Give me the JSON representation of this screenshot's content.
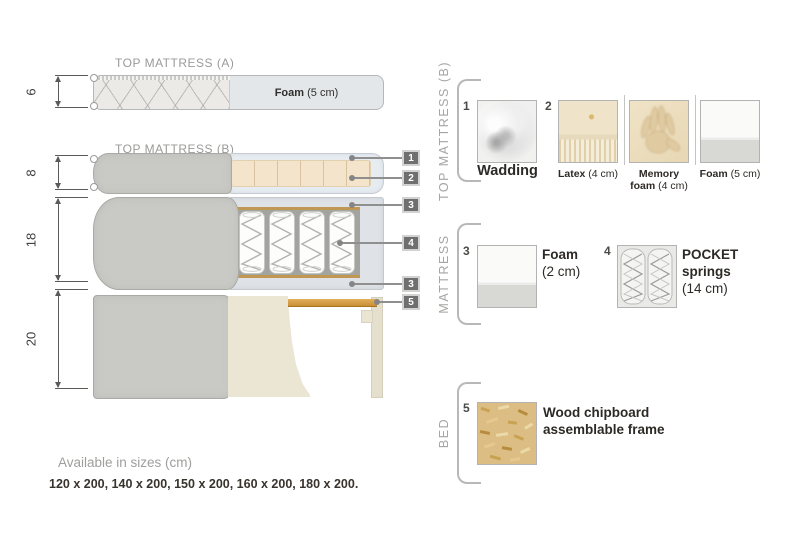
{
  "diagram": {
    "sections": {
      "top_a": {
        "title": "TOP MATTRESS (A)",
        "height_cm": "6",
        "foam_bold": "Foam",
        "foam_rest": " (5 cm)"
      },
      "top_b": {
        "title": "TOP MATTRESS (B)",
        "height_cm": "8"
      },
      "mattress": {
        "height_cm": "18"
      },
      "bed": {
        "height_cm": "20"
      }
    },
    "callouts": {
      "c1": "1",
      "c2": "2",
      "c3": "3",
      "c4": "4",
      "c3b": "3",
      "c5": "5"
    }
  },
  "legend": {
    "top_b": {
      "title": "TOP MATTRESS (B)",
      "wadding": {
        "num": "1",
        "label": "Wadding"
      },
      "latex": {
        "num": "2",
        "bold": "Latex",
        "rest": " (4 cm)"
      },
      "memory": {
        "line1": "Memory",
        "bold2": "foam",
        "rest2": " (4 cm)"
      },
      "foam": {
        "bold": "Foam",
        "rest": " (5 cm)"
      }
    },
    "mattress": {
      "title": "MATTRESS",
      "foam": {
        "num": "3",
        "bold": "Foam",
        "size": "(2 cm)"
      },
      "pocket": {
        "num": "4",
        "bold1": "POCKET",
        "bold2": "springs",
        "size": "(14 cm)"
      }
    },
    "bed": {
      "title": "BED",
      "chipboard": {
        "num": "5",
        "line1": "Wood chipboard",
        "line2": "assemblable frame"
      }
    }
  },
  "footer": {
    "sizes_title": "Available in sizes (cm)",
    "sizes_list": "120 x 200, 140 x 200, 150 x 200, 160 x 200, 180 x 200."
  },
  "colors": {
    "wood_slat": "#cc9538",
    "fabric_gray": "#c9c9c5",
    "latex_tan": "#f3e4cb",
    "callout_gray": "#6f6f6f"
  }
}
